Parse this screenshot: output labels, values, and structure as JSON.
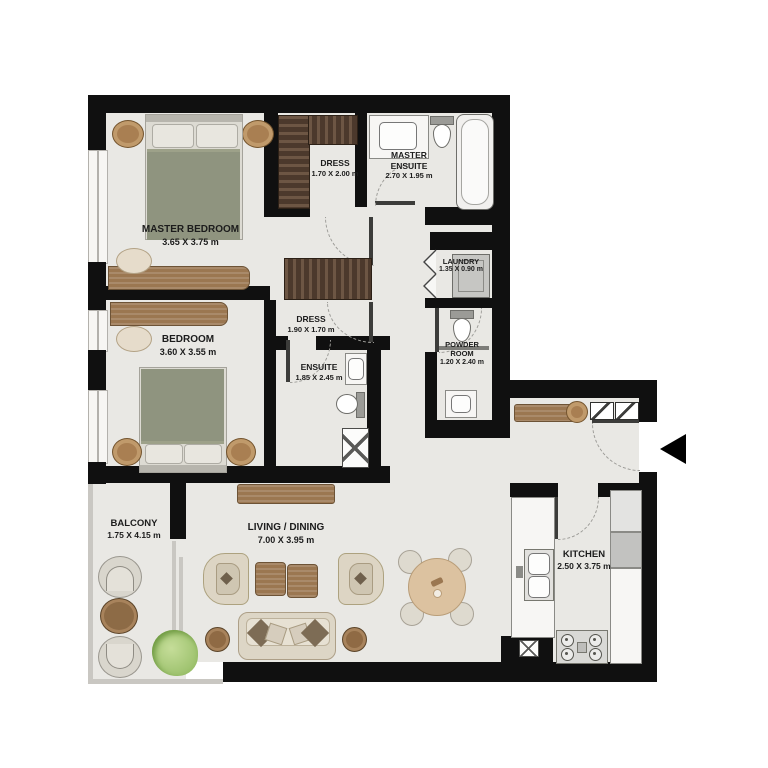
{
  "plan_title": "apartment-floor-plan",
  "rooms": {
    "master_bedroom": {
      "name": "MASTER BEDROOM",
      "dims": "3.65 X 3.75 m"
    },
    "dress_1": {
      "name": "DRESS",
      "dims": "1.70 X 2.00 m"
    },
    "master_ensuite": {
      "name": "MASTER ENSUITE",
      "dims": "2.70 X 1.95 m"
    },
    "laundry": {
      "name": "LAUNDRY",
      "dims": "1.35 X 0.90 m"
    },
    "powder_room": {
      "name": "POWDER ROOM",
      "dims": "1.20 X 2.40 m"
    },
    "bedroom": {
      "name": "BEDROOM",
      "dims": "3.60 X 3.55 m"
    },
    "dress_2": {
      "name": "DRESS",
      "dims": "1.90 X 1.70 m"
    },
    "ensuite": {
      "name": "ENSUITE",
      "dims": "1.85 X 2.45 m"
    },
    "balcony": {
      "name": "BALCONY",
      "dims": "1.75 X 4.15 m"
    },
    "living_dining": {
      "name": "LIVING / DINING",
      "dims": "7.00 X 3.95 m"
    },
    "kitchen": {
      "name": "KITCHEN",
      "dims": "2.50 X 3.75 m"
    }
  },
  "colors": {
    "wall": "#101010",
    "floor": "#e9e8e4",
    "wood_dark": "#4c392c",
    "wood": "#9b7751",
    "bedding": "#8f947f",
    "fixture_outline": "#8a8a86",
    "entry_arrow": "#000000"
  },
  "icons": {
    "entry_arrow": "left-pointing solid triangle marking apartment entrance"
  }
}
